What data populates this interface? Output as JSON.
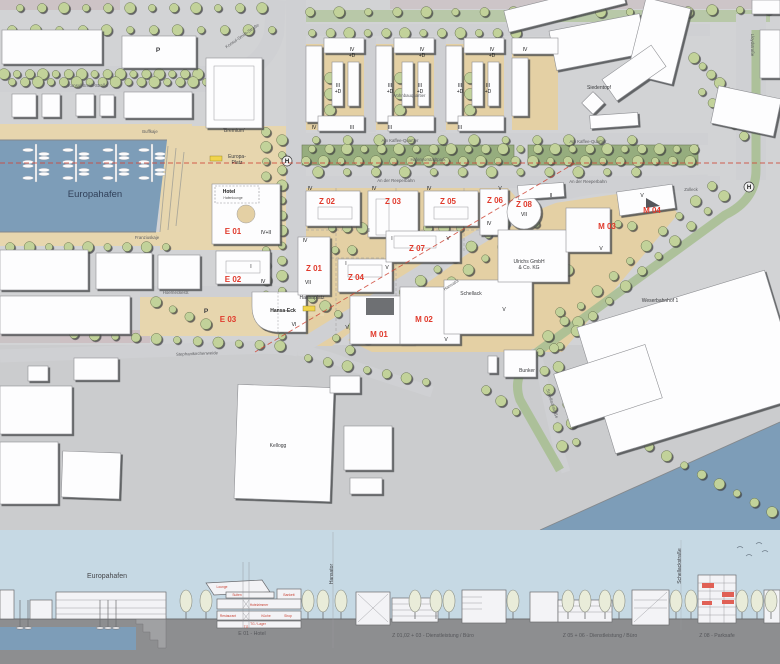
{
  "colors": {
    "water": "#7d9db8",
    "ground_tan": "#e4d0a4",
    "park_green": "#96ad7e",
    "tree_green": "#c2d29a",
    "building_white": "#fdfdfe",
    "accent_red": "#e03a2c",
    "section_sky": "#c6d9e4",
    "section_ground": "#8d8e90",
    "bus_stop_yellow": "#f0d44c"
  },
  "map": {
    "labels": [
      {
        "t": "E 01",
        "x": 233,
        "y": 234,
        "c": "id"
      },
      {
        "t": "E 02",
        "x": 233,
        "y": 282,
        "c": "id"
      },
      {
        "t": "E 03",
        "x": 228,
        "y": 322,
        "c": "id"
      },
      {
        "t": "Z 01",
        "x": 314,
        "y": 271,
        "c": "id"
      },
      {
        "t": "Z 02",
        "x": 327,
        "y": 204,
        "c": "id"
      },
      {
        "t": "Z 03",
        "x": 393,
        "y": 204,
        "c": "id"
      },
      {
        "t": "Z 04",
        "x": 356,
        "y": 280,
        "c": "id"
      },
      {
        "t": "Z 05",
        "x": 448,
        "y": 204,
        "c": "id"
      },
      {
        "t": "Z 06",
        "x": 495,
        "y": 203,
        "c": "id"
      },
      {
        "t": "Z 07",
        "x": 417,
        "y": 251,
        "c": "id"
      },
      {
        "t": "Z 08",
        "x": 524,
        "y": 207,
        "c": "id"
      },
      {
        "t": "M 01",
        "x": 379,
        "y": 337,
        "c": "id"
      },
      {
        "t": "M 02",
        "x": 424,
        "y": 322,
        "c": "id"
      },
      {
        "t": "M 03",
        "x": 607,
        "y": 229,
        "c": "id"
      },
      {
        "t": "M 04",
        "x": 652,
        "y": 213,
        "c": "id"
      },
      {
        "t": "IV+II",
        "x": 266,
        "y": 234,
        "c": "num"
      },
      {
        "t": "I",
        "x": 251,
        "y": 268,
        "c": "num"
      },
      {
        "t": "IV",
        "x": 263,
        "y": 283,
        "c": "num"
      },
      {
        "t": "VI",
        "x": 294,
        "y": 326,
        "c": "num"
      },
      {
        "t": "IV",
        "x": 352,
        "y": 51,
        "c": "num"
      },
      {
        "t": "+D",
        "x": 352,
        "y": 57,
        "c": "num"
      },
      {
        "t": "III",
        "x": 338,
        "y": 87,
        "c": "num"
      },
      {
        "t": "+D",
        "x": 338,
        "y": 93,
        "c": "num"
      },
      {
        "t": "IV",
        "x": 314,
        "y": 129,
        "c": "num"
      },
      {
        "t": "III",
        "x": 352,
        "y": 129,
        "c": "num"
      },
      {
        "t": "IV",
        "x": 422,
        "y": 51,
        "c": "num"
      },
      {
        "t": "+D",
        "x": 422,
        "y": 57,
        "c": "num"
      },
      {
        "t": "III",
        "x": 390,
        "y": 87,
        "c": "num"
      },
      {
        "t": "+D",
        "x": 390,
        "y": 93,
        "c": "num"
      },
      {
        "t": "III",
        "x": 420,
        "y": 87,
        "c": "num"
      },
      {
        "t": "+D",
        "x": 420,
        "y": 93,
        "c": "num"
      },
      {
        "t": "III",
        "x": 390,
        "y": 129,
        "c": "num"
      },
      {
        "t": "IV",
        "x": 492,
        "y": 51,
        "c": "num"
      },
      {
        "t": "+D",
        "x": 492,
        "y": 57,
        "c": "num"
      },
      {
        "t": "III",
        "x": 460,
        "y": 87,
        "c": "num"
      },
      {
        "t": "+D",
        "x": 460,
        "y": 93,
        "c": "num"
      },
      {
        "t": "III",
        "x": 488,
        "y": 87,
        "c": "num"
      },
      {
        "t": "+D",
        "x": 488,
        "y": 93,
        "c": "num"
      },
      {
        "t": "III",
        "x": 460,
        "y": 129,
        "c": "num"
      },
      {
        "t": "IV",
        "x": 525,
        "y": 51,
        "c": "num"
      },
      {
        "t": "IV",
        "x": 310,
        "y": 190,
        "c": "num"
      },
      {
        "t": "IV",
        "x": 374,
        "y": 190,
        "c": "num"
      },
      {
        "t": "I",
        "x": 369,
        "y": 232,
        "c": "num"
      },
      {
        "t": "IV",
        "x": 429,
        "y": 190,
        "c": "num"
      },
      {
        "t": "V",
        "x": 500,
        "y": 190,
        "c": "num"
      },
      {
        "t": "IV",
        "x": 489,
        "y": 225,
        "c": "num"
      },
      {
        "t": "VII",
        "x": 524,
        "y": 216,
        "c": "num"
      },
      {
        "t": "IV",
        "x": 305,
        "y": 242,
        "c": "num"
      },
      {
        "t": "VII",
        "x": 308,
        "y": 284,
        "c": "num"
      },
      {
        "t": "I",
        "x": 346,
        "y": 265,
        "c": "num"
      },
      {
        "t": "V",
        "x": 387,
        "y": 269,
        "c": "num"
      },
      {
        "t": "I",
        "x": 392,
        "y": 240,
        "c": "num"
      },
      {
        "t": "V",
        "x": 448,
        "y": 240,
        "c": "num"
      },
      {
        "t": "II",
        "x": 551,
        "y": 197,
        "c": "num"
      },
      {
        "t": "V",
        "x": 642,
        "y": 197,
        "c": "num"
      },
      {
        "t": "V",
        "x": 601,
        "y": 250,
        "c": "num"
      },
      {
        "t": "V",
        "x": 504,
        "y": 311,
        "c": "num"
      },
      {
        "t": "V",
        "x": 347,
        "y": 329,
        "c": "num"
      },
      {
        "t": "V",
        "x": 446,
        "y": 341,
        "c": "num"
      },
      {
        "t": "Konsul-Smidt-Straße",
        "x": 88,
        "y": 87,
        "c": "st"
      },
      {
        "t": "Konsul-Smidt-Straße",
        "x": 243,
        "y": 37,
        "c": "st",
        "r": -35
      },
      {
        "t": "Buffkaje",
        "x": 150,
        "y": 133,
        "c": "st"
      },
      {
        "t": "Franziuskaje",
        "x": 147,
        "y": 239,
        "c": "st"
      },
      {
        "t": "Hoerneckestr.",
        "x": 176,
        "y": 294,
        "c": "st"
      },
      {
        "t": "Stephanikirchenweide",
        "x": 197,
        "y": 355,
        "c": "st",
        "r": -2
      },
      {
        "t": "Am Kaffee-Quartier",
        "x": 400,
        "y": 142,
        "c": "st"
      },
      {
        "t": "Am Kaffee-Quartier",
        "x": 588,
        "y": 143,
        "c": "st"
      },
      {
        "t": "An der Reeperbahn",
        "x": 396,
        "y": 182,
        "c": "st"
      },
      {
        "t": "An der Reeperbahn",
        "x": 588,
        "y": 183,
        "c": "st"
      },
      {
        "t": "Hansator",
        "x": 452,
        "y": 286,
        "c": "st",
        "r": -33
      },
      {
        "t": "Lloydstraße",
        "x": 751,
        "y": 45,
        "c": "st",
        "r": 90
      },
      {
        "t": "Schellackstraße",
        "x": 551,
        "y": 404,
        "c": "st",
        "r": 72
      },
      {
        "t": "Zolleck",
        "x": 691,
        "y": 191,
        "c": "st"
      },
      {
        "t": "Hafenvorstadtpark",
        "x": 428,
        "y": 161,
        "c": "st"
      },
      {
        "t": "Wohnbauquartier",
        "x": 409,
        "y": 97,
        "c": "st"
      },
      {
        "t": "Hansaplatz",
        "x": 312,
        "y": 299,
        "c": "pl"
      },
      {
        "t": "Europa-",
        "x": 237,
        "y": 158,
        "c": "pl"
      },
      {
        "t": "Platz",
        "x": 237,
        "y": 164,
        "c": "pl"
      },
      {
        "t": "Bunker",
        "x": 527,
        "y": 372,
        "c": "pl"
      },
      {
        "t": "Kellogg",
        "x": 278,
        "y": 447,
        "c": "pl"
      },
      {
        "t": "Siedentopf",
        "x": 599,
        "y": 89,
        "c": "pl"
      },
      {
        "t": "Schellack",
        "x": 471,
        "y": 295,
        "c": "pl"
      },
      {
        "t": "Ulrichs GmbH",
        "x": 529,
        "y": 263,
        "c": "pl"
      },
      {
        "t": "& Co. KG",
        "x": 529,
        "y": 269,
        "c": "pl"
      },
      {
        "t": "Weserbahnhof 1",
        "x": 660,
        "y": 302,
        "c": "pl"
      },
      {
        "t": "'Bremium'",
        "x": 234,
        "y": 132,
        "c": "pl"
      },
      {
        "t": "Hansa-Eck",
        "x": 283,
        "y": 312,
        "c": "bold"
      },
      {
        "t": "Hotel",
        "x": 229,
        "y": 193,
        "c": "bold"
      },
      {
        "t": "Hafenlounge",
        "x": 233,
        "y": 199,
        "c": "tiny"
      },
      {
        "t": "P",
        "x": 158,
        "y": 52,
        "c": "p"
      },
      {
        "t": "P",
        "x": 206,
        "y": 313,
        "c": "p"
      },
      {
        "t": "H",
        "x": 287,
        "y": 163,
        "c": "h"
      },
      {
        "t": "H",
        "x": 749,
        "y": 189,
        "c": "h"
      },
      {
        "t": "Europahafen",
        "x": 95,
        "y": 197,
        "c": "wa"
      }
    ]
  },
  "section": {
    "labels": [
      {
        "t": "Europahafen",
        "x": 107,
        "y": 578,
        "c": "pl6"
      },
      {
        "t": "Hansator",
        "x": 333,
        "y": 574,
        "c": "vert",
        "r": -90
      },
      {
        "t": "Schellackstraße",
        "x": 681,
        "y": 566,
        "c": "vert",
        "r": -90
      },
      {
        "t": "E 01  -  Hotel",
        "x": 252,
        "y": 635,
        "c": "cap"
      },
      {
        "t": "Z 01,02 + 03  -  Dienstleistung / Büro",
        "x": 433,
        "y": 637,
        "c": "cap"
      },
      {
        "t": "Z 05 + 06  -  Dienstleistung / Büro",
        "x": 600,
        "y": 637,
        "c": "cap"
      },
      {
        "t": "Z 08  -  Parksafe",
        "x": 717,
        "y": 637,
        "c": "cap"
      },
      {
        "t": "Lounge",
        "x": 222,
        "y": 588,
        "c": "room"
      },
      {
        "t": "Suiten",
        "x": 237,
        "y": 596,
        "c": "room"
      },
      {
        "t": "Bankett",
        "x": 289,
        "y": 596,
        "c": "room"
      },
      {
        "t": "Hotelzimmer",
        "x": 259,
        "y": 606,
        "c": "room"
      },
      {
        "t": "Restaurant",
        "x": 228,
        "y": 617,
        "c": "room"
      },
      {
        "t": "Küche",
        "x": 266,
        "y": 617,
        "c": "room"
      },
      {
        "t": "Shop",
        "x": 288,
        "y": 617,
        "c": "room"
      },
      {
        "t": "TG / Lager",
        "x": 258,
        "y": 625,
        "c": "room"
      },
      {
        "t": "TG",
        "x": 246,
        "y": 628,
        "c": "room"
      }
    ]
  }
}
